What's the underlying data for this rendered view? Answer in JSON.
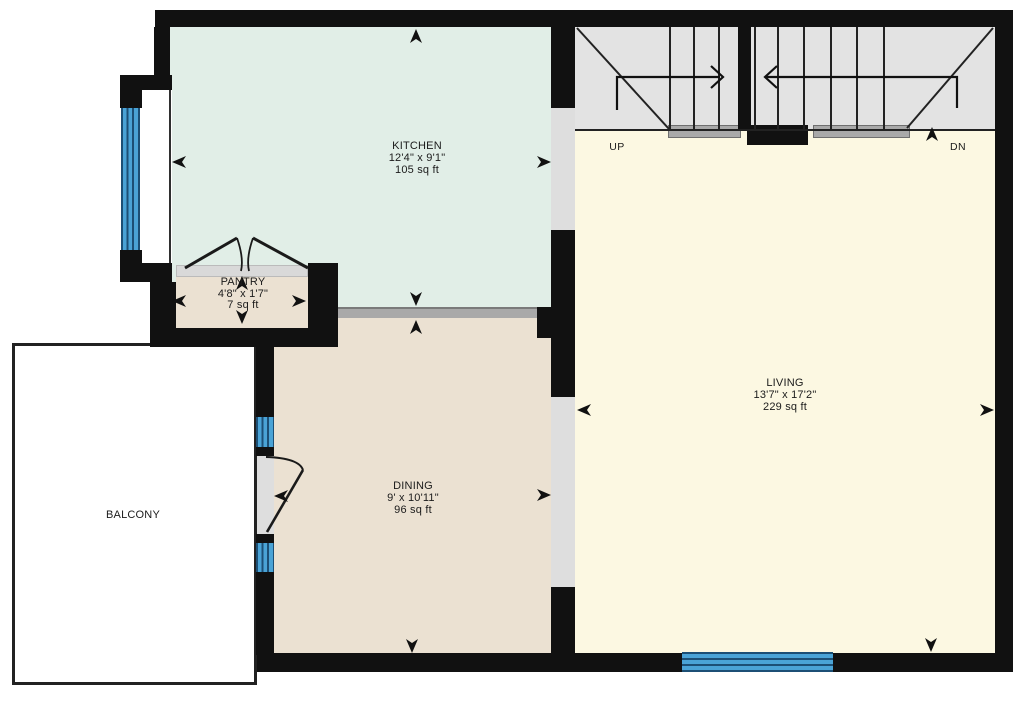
{
  "plan": {
    "rooms": {
      "kitchen": {
        "name": "KITCHEN",
        "dimensions": "12'4\" x 9'1\"",
        "area": "105 sq ft",
        "fill": "#e1eee7"
      },
      "pantry": {
        "name": "PANTRY",
        "dimensions": "4'8\" x 1'7\"",
        "area": "7 sq ft",
        "fill": "#ebe1d2"
      },
      "dining": {
        "name": "DINING",
        "dimensions": "9' x 10'11\"",
        "area": "96 sq ft",
        "fill": "#ebe1d2"
      },
      "living": {
        "name": "LIVING",
        "dimensions": "13'7\" x 17'2\"",
        "area": "229 sq ft",
        "fill": "#fcf8e2"
      },
      "balcony": {
        "name": "BALCONY",
        "fill": "#ffffff"
      }
    },
    "stairs": {
      "up_label": "UP",
      "down_label": "DN",
      "fill": "#e3e3e3"
    },
    "colors": {
      "wall": "#111111",
      "window_glass": "#4aa3d6",
      "window_frame": "#1c4f75",
      "opening": "#dedede",
      "landing": "#a9a9a9",
      "room_divider": "#a9a9a9",
      "arrow": "#111111",
      "text": "#1b1b1b"
    }
  }
}
